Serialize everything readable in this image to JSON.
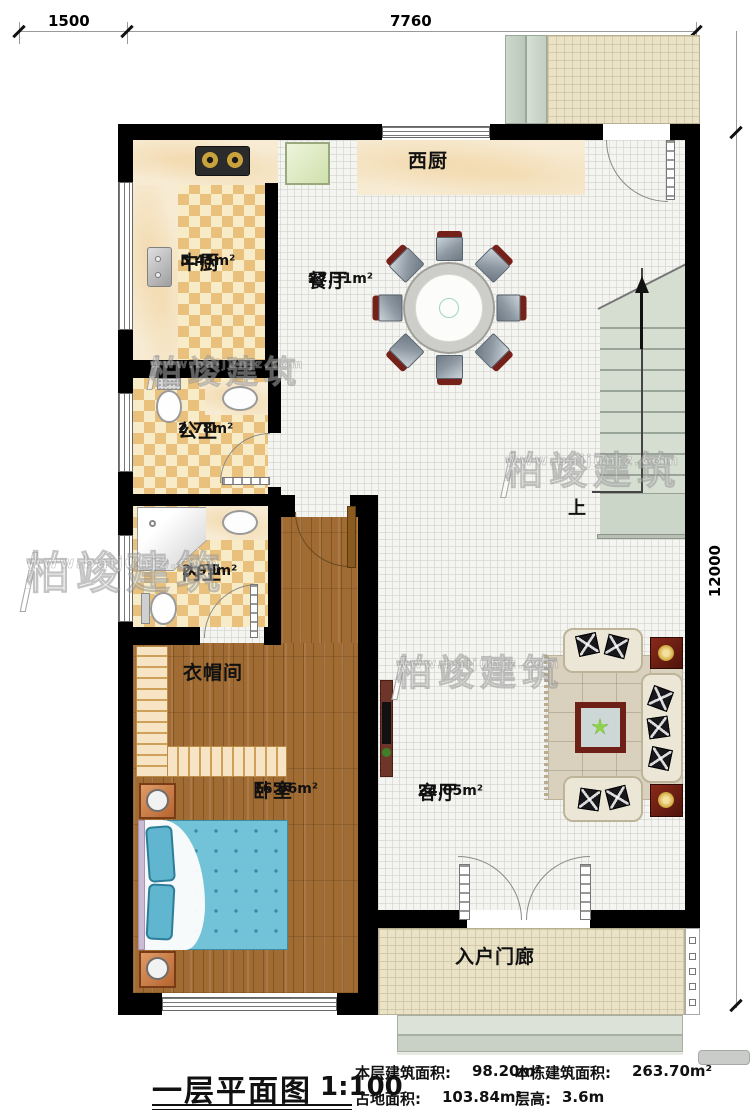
{
  "dimensions": {
    "top_segment_1": "1500",
    "top_segment_2": "7760",
    "right_total": "12000"
  },
  "rooms": {
    "west_kitchen": {
      "name": "西厨"
    },
    "main_kitchen": {
      "name": "中厨",
      "area": "5.45m²"
    },
    "dining_room": {
      "name": "餐厅",
      "area": "27.31m²"
    },
    "guest_bath": {
      "name": "公卫",
      "area": "2.78m²"
    },
    "master_bath": {
      "name": "内卫",
      "area": "2.99m²"
    },
    "cloakroom": {
      "name": "衣帽间"
    },
    "bedroom": {
      "name": "卧室",
      "area": "16.96m²"
    },
    "living_room": {
      "name": "客厅",
      "area": "24.05m²"
    },
    "entry_porch": {
      "name": "入户门廊"
    },
    "stairs": {
      "direction_label": "上"
    }
  },
  "title_block": {
    "title": "一层平面图",
    "scale": "1:100",
    "stats": [
      {
        "label": "本层建筑面积:",
        "value": "98.20m²"
      },
      {
        "label": "占地面积:",
        "value": "103.84m²"
      },
      {
        "label": "本栋建筑面积:",
        "value": "263.70m²"
      },
      {
        "label": "层高:",
        "value": "3.6m"
      }
    ]
  },
  "watermark": {
    "brand": "柏竣建筑",
    "url": "www.baijunjz.com"
  },
  "colors": {
    "wall": "#000000",
    "wood_floor": "#a06c33",
    "tile_checker": "#e9c17c",
    "bed_blue": "#72c2d8",
    "accent_red_wood": "#6e2016",
    "stair_green": "#d6ded2",
    "paving": "#eae3c8"
  }
}
